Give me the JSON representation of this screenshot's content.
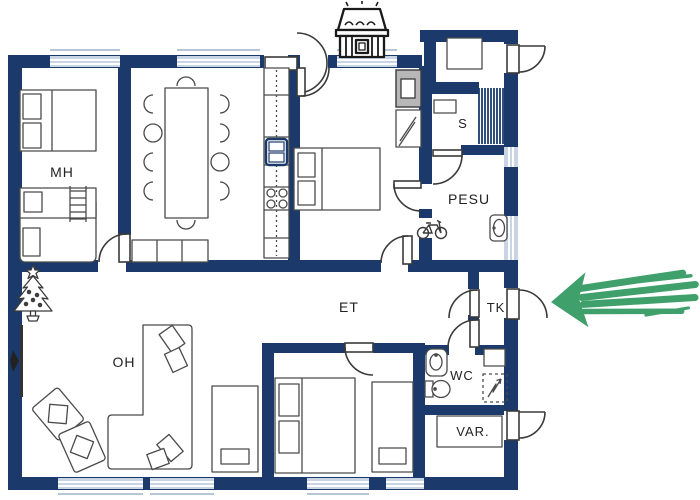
{
  "floorplan": {
    "room_labels": {
      "master_bedroom": "MH",
      "sauna": "S",
      "utility_room": "PESU",
      "entry_hall": "ET",
      "vestibule": "TK",
      "living_room": "OH",
      "wc": "WC",
      "storage": "VAR."
    },
    "colors": {
      "wall": "#1b3a6b",
      "window_glass": "#c9d4e4",
      "furniture_outline": "#4a4a4a",
      "door_outline": "#3a3a3a",
      "fireplace_gray": "#b7b7b7",
      "arrow_green": "#3fa06c",
      "label_text": "#222222"
    },
    "icons": {
      "grill": "bbq-grill",
      "tree": "christmas-tree",
      "bike": "bicycle",
      "tv": "tv-screen",
      "arrow": "highlight-arrow"
    }
  }
}
